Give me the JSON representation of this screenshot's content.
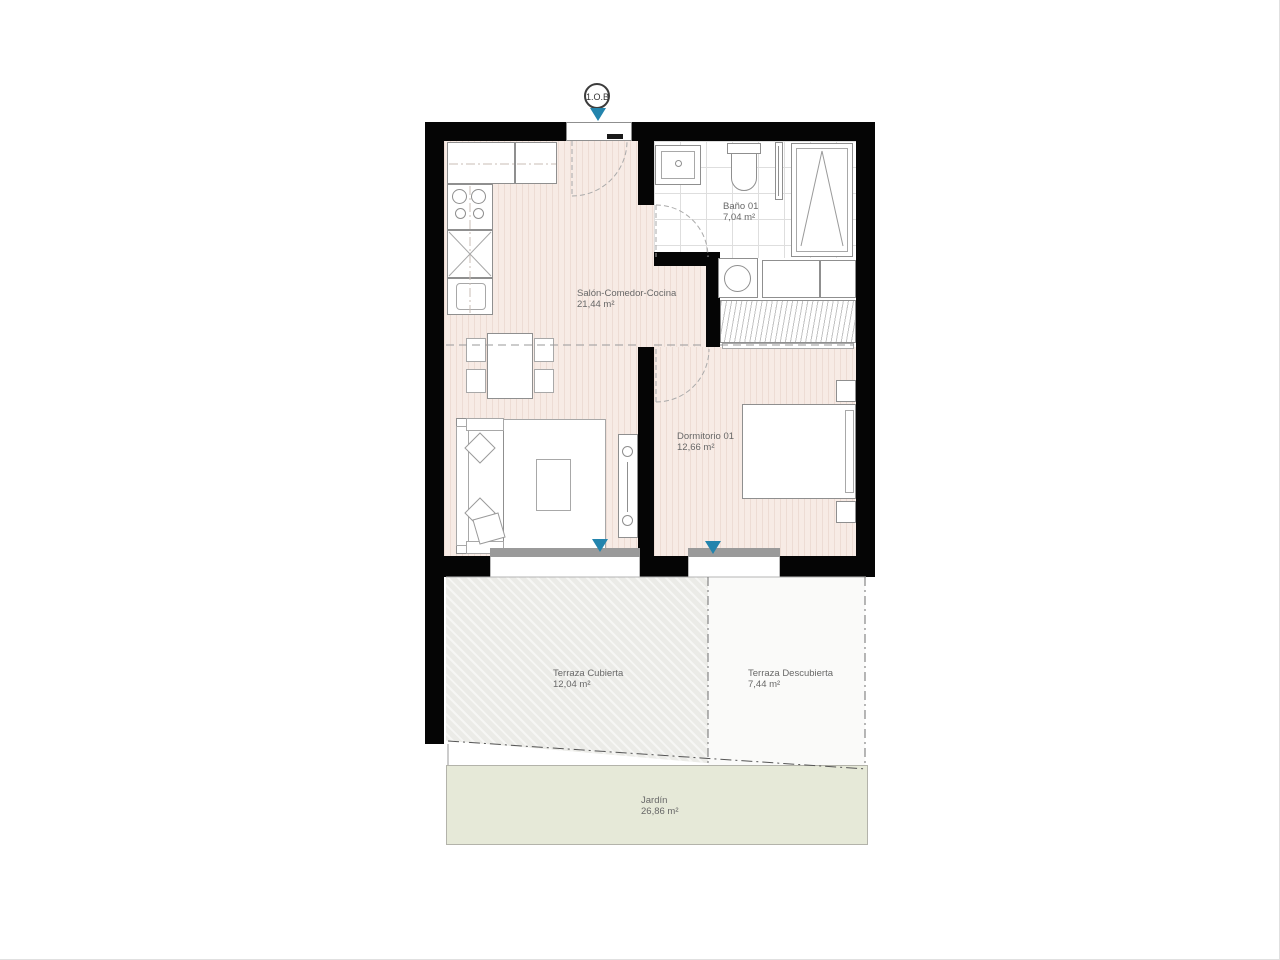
{
  "plan": {
    "unit_label": "1.O.B",
    "rooms": [
      {
        "name": "Salón-Comedor-Cocina",
        "area": "21,44 m²"
      },
      {
        "name": "Baño 01",
        "area": "7,04 m²"
      },
      {
        "name": "Dormitorio 01",
        "area": "12,66 m²"
      },
      {
        "name": "Terraza Cubierta",
        "area": "12,04 m²"
      },
      {
        "name": "Terraza Descubierta",
        "area": "7,44 m²"
      },
      {
        "name": "Jardín",
        "area": "26,86 m²"
      }
    ],
    "colors": {
      "wall": "#050505",
      "floor": "#f7ebe5",
      "floor_stripe": "#eddcd4",
      "tile_line": "#dedede",
      "terrace_covered": "#ebebe7",
      "garden": "#e6e9d8",
      "window_sill": "#9a9a9a",
      "direction_marker": "#2384ad",
      "label_text": "#686868"
    }
  }
}
